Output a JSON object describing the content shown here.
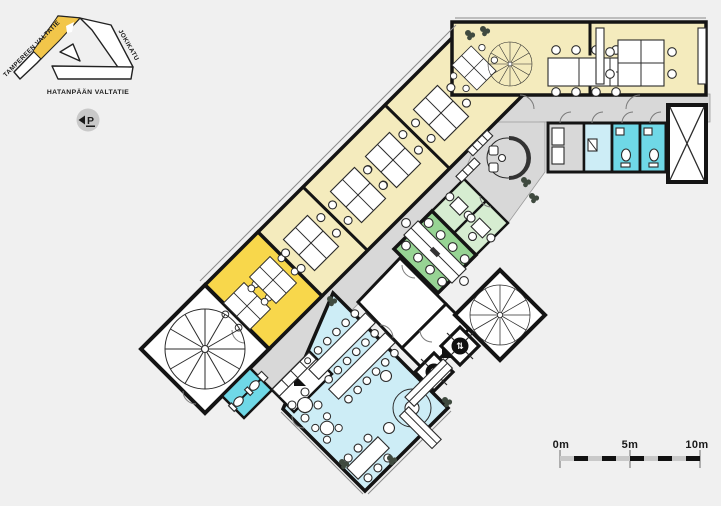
{
  "site_map": {
    "street_top_left": "TAMPEREEN VALTATIE",
    "street_right": "JOKIKATU",
    "street_bottom": "HATANPÄÄN VALTATIE"
  },
  "parking_sign": {
    "letter": "P"
  },
  "scale_bar": {
    "label_start": "0m",
    "label_mid": "5m",
    "label_end": "10m"
  },
  "icons": {
    "parking_direction_arrow": "◀",
    "elevator_updown": "⇅"
  },
  "colors": {
    "background": "#f0f0f0",
    "wall": "#141414",
    "corridor_gray": "#d8d8d8",
    "open_office_cream": "#f4ebbd",
    "office_yellow": "#f8d74b",
    "site_map_yellow": "#f2c64a",
    "meeting_green": "#97d494",
    "meeting_green_light": "#d6edd1",
    "wet_room_cyan": "#6fd8e7",
    "cafeteria_cyan": "#cdedf6",
    "room_white": "#ffffff",
    "plant_dark": "#3f4a3f",
    "scale_bar_gray": "#c9c9c9",
    "parking_badge_gray": "#c9c9c9"
  }
}
